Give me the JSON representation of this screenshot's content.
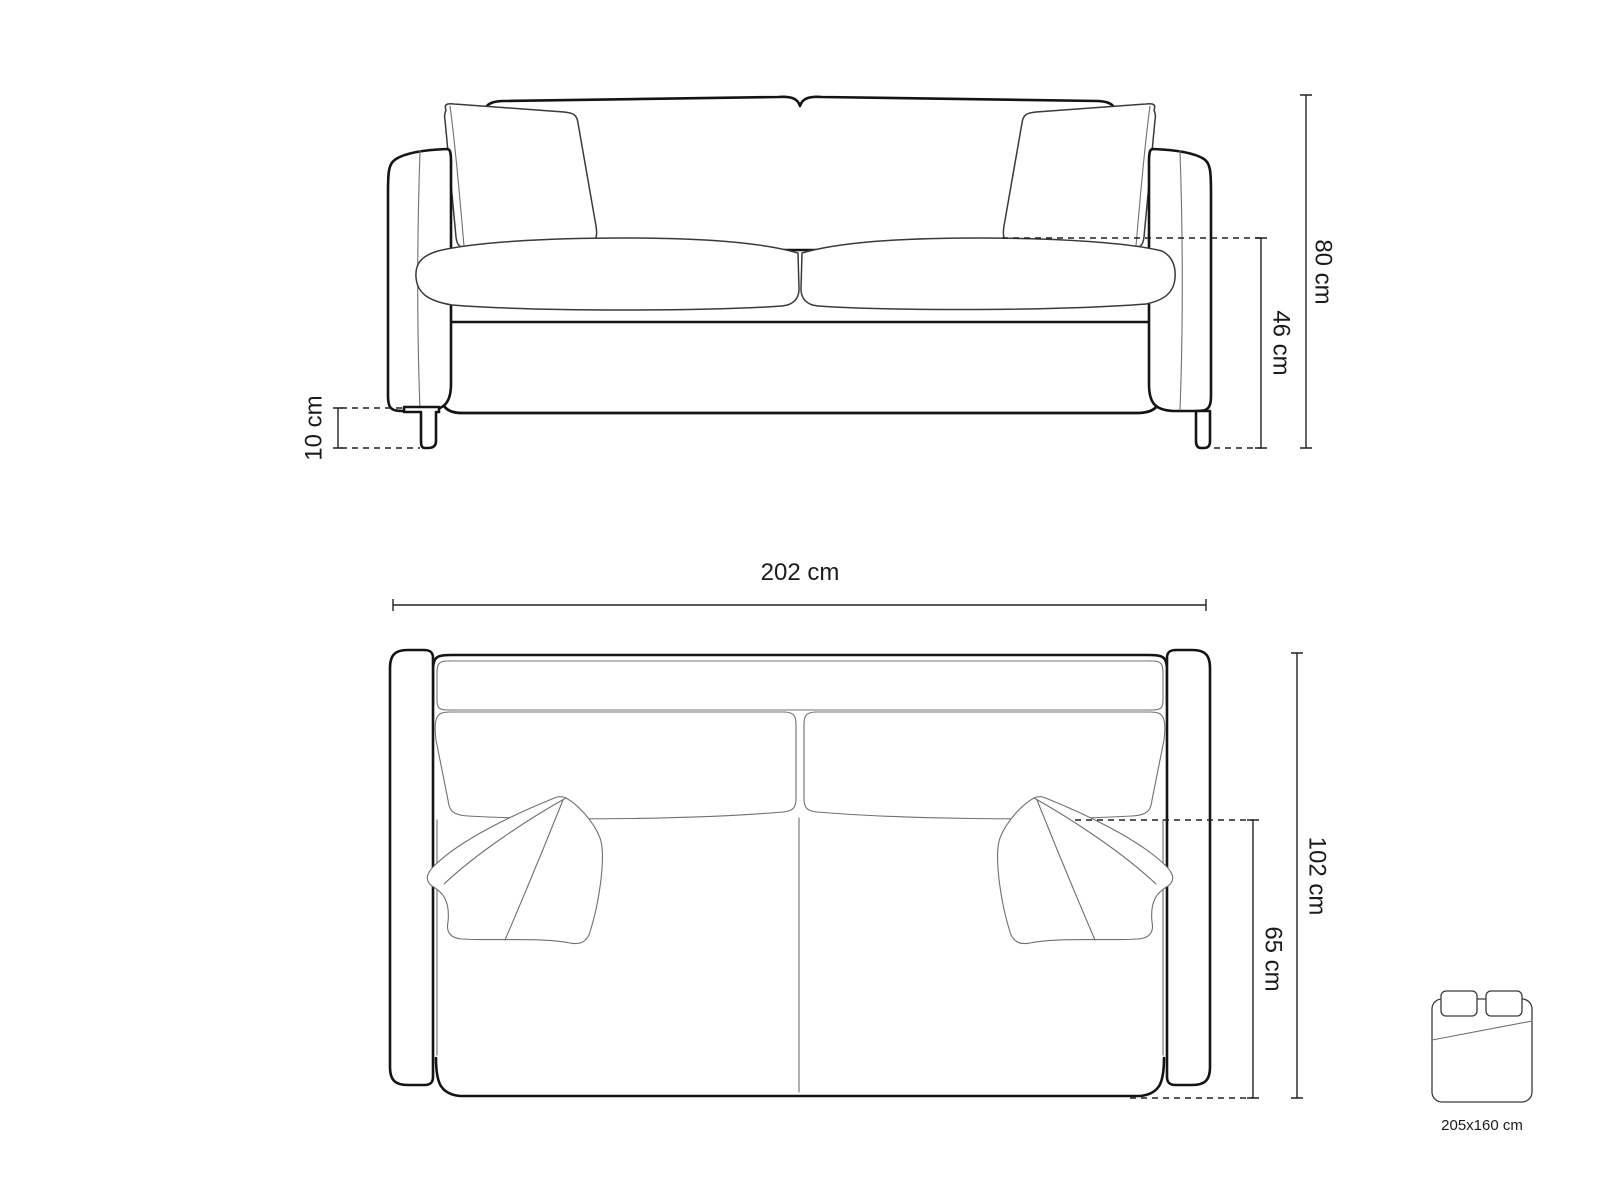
{
  "diagram": {
    "title": "sofa-technical-drawing",
    "front_view": {
      "overall_height": "80 cm",
      "seat_height": "46 cm",
      "leg_height": "10 cm"
    },
    "top_view": {
      "overall_width": "202 cm",
      "overall_depth": "102 cm",
      "seat_depth": "65 cm"
    },
    "sleeping_area": {
      "label": "205x160 cm"
    },
    "colors": {
      "outline": "#141414",
      "detail": "#707070",
      "dimension": "#222222",
      "background": "#ffffff"
    }
  }
}
